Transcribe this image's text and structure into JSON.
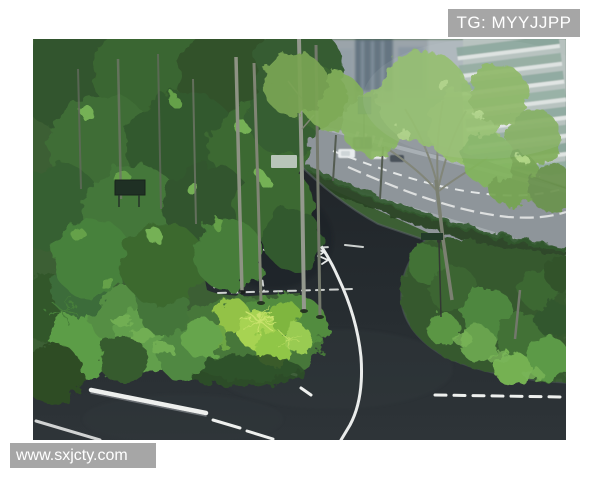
{
  "watermarks": {
    "top_right": "TG: MYYJJPP",
    "bottom_left": "www.sxjcty.com"
  },
  "photo": {
    "description": "Aerial view of a dark asphalt garden path with white road markings curving through lush landscaped greenery, with a gray city street, cars and high-rise buildings at the top right",
    "palette": {
      "background": "#ffffff",
      "watermark_bg": "#a6a6a6",
      "watermark_text": "#ffffff",
      "asphalt": "#1d2327",
      "street": "#8a9196",
      "marking": "#f1f3f2",
      "foliage_dark": "#1f3a1e",
      "foliage_mid": "#3a6132",
      "foliage_bright": "#8fc040"
    }
  }
}
